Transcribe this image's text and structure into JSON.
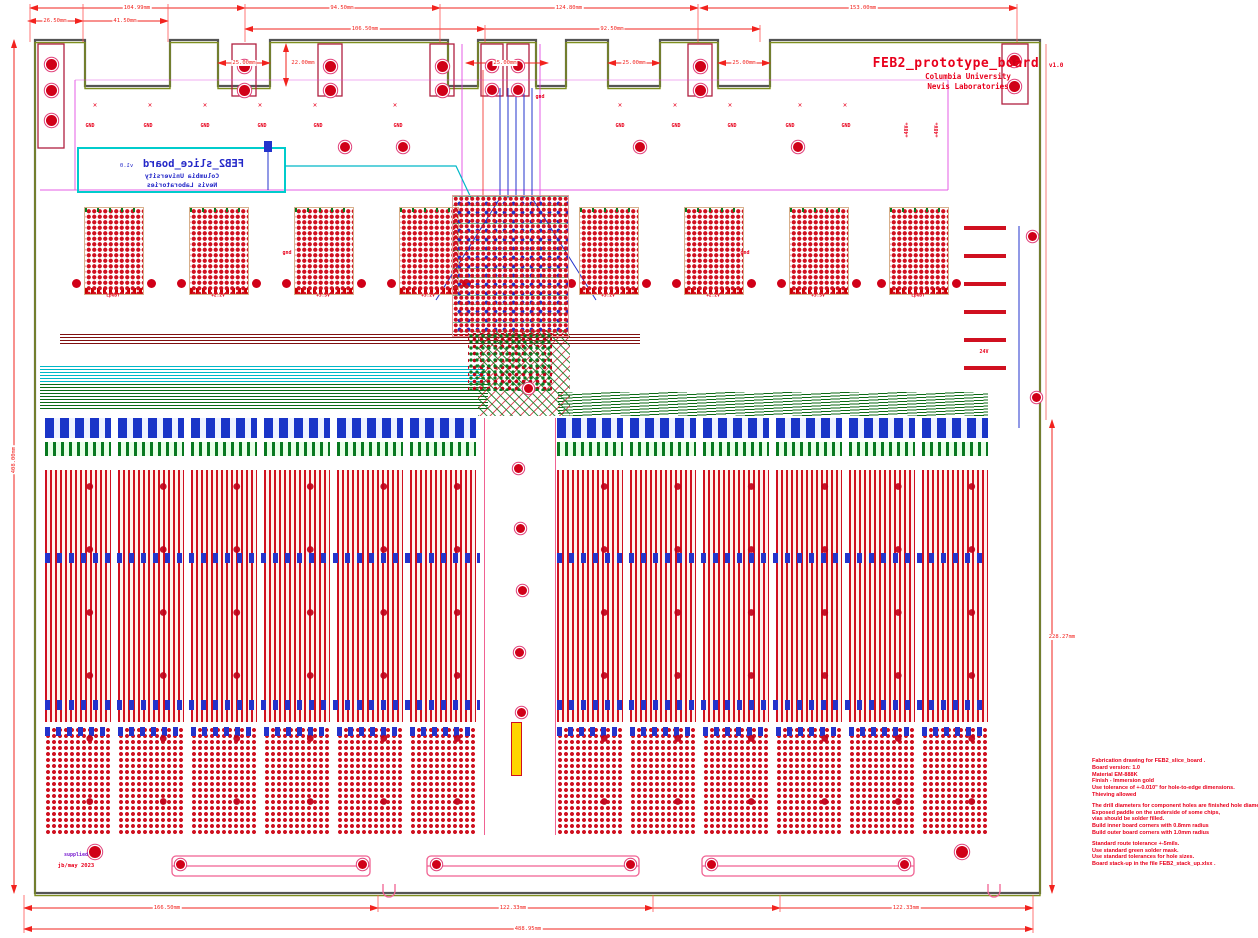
{
  "title_block": {
    "name": "FEB2_prototype_board",
    "version": "v1.0",
    "org": "Columbia University",
    "lab": "Nevis Laboratories"
  },
  "silkscreen": {
    "name": "FEB2_slice_board",
    "version": "v1.0",
    "org": "Columbia University",
    "lab": "Nevis Laboratories"
  },
  "net": {
    "gnd_row": [
      "GND",
      "GND",
      "GND",
      "GND",
      "GND",
      "GND",
      "GND",
      "GND",
      "GND",
      "GND",
      "GND"
    ],
    "p48_1": "+48V+",
    "p48_2": "+48V+",
    "v24": "24V",
    "gnd_1": "gnd",
    "gnd_2": "gnd",
    "gnd_3": "gnd"
  },
  "rails": [
    "LpGBT",
    "+2.2V",
    "+3.5V",
    "+3.2V",
    "+3.2V",
    "+2.2V",
    "+3.5V",
    "LpGBT"
  ],
  "dims": {
    "top_row1": [
      "104.99mm",
      "94.50mm",
      "124.80mm",
      "153.00mm"
    ],
    "top_row2": [
      "26.50mm",
      "41.50mm",
      "106.50mm",
      "92.50mm"
    ],
    "top_small": [
      "25.00mm",
      "22.00mm",
      "25.00mm",
      "25.00mm",
      "25.00mm"
    ],
    "bottom": [
      "166.50mm",
      "122.33mm",
      "122.33mm"
    ],
    "bottom_overall": "488.95mm",
    "left_overall": "408.00mm",
    "right_side": "228.27mm"
  },
  "notes": {
    "lines": [
      "Fabrication drawing for FEB2_slice_board .",
      "Board version: 1.0",
      "Material EM-888K",
      "Finish - Immersion gold",
      "Use tolerance of +-0.010\" for hole-to-edge dimensions.",
      "Thieving allowed",
      "",
      "The drill diameters for component holes are finished hole diameters",
      "Exposed paddle on the underside of some chips,",
      "vias should be solder filled.",
      "Build inner board corners with 0.8mm radius",
      "Build outer board corners with 1.0mm radius",
      "",
      "Standard route tolerance +-5mils.",
      "Use standard green solder mask.",
      "Use standard tolerances for hole sizes.",
      "Board stack-up in the file FEB2_stack_up.xlsx ."
    ]
  },
  "footer": {
    "note": "supplied",
    "date": "jb/may 2023"
  },
  "icons": {
    "x_mark": "✕"
  },
  "colors": {
    "dim_red": "#f2231e",
    "silk_red": "#e8001c",
    "silk_blue": "#2327c8",
    "copper_red": "#d01020",
    "ground_green": "#0b6b14",
    "teal": "#00cccc",
    "magenta": "#e040e0",
    "pink": "#f06292"
  },
  "drills": [
    [
      51,
      64,
      5.5
    ],
    [
      51,
      90,
      5.5
    ],
    [
      51,
      120,
      5.5
    ],
    [
      244,
      66,
      5.5
    ],
    [
      244,
      90,
      5.5
    ],
    [
      330,
      66,
      5.5
    ],
    [
      330,
      90,
      5.5
    ],
    [
      442,
      66,
      5.5
    ],
    [
      442,
      90,
      5.5
    ],
    [
      492,
      66,
      5
    ],
    [
      492,
      90,
      5
    ],
    [
      518,
      66,
      5
    ],
    [
      518,
      90,
      5
    ],
    [
      700,
      66,
      5.5
    ],
    [
      700,
      90,
      5.5
    ],
    [
      1014,
      60,
      5.5
    ],
    [
      1014,
      86,
      5.5
    ],
    [
      345,
      147,
      5
    ],
    [
      403,
      147,
      5
    ],
    [
      640,
      147,
      5
    ],
    [
      798,
      147,
      5
    ],
    [
      518,
      468,
      4.5
    ],
    [
      520,
      528,
      4.5
    ],
    [
      522,
      590,
      4.5
    ],
    [
      519,
      652,
      4.5
    ],
    [
      521,
      712,
      4.5
    ],
    [
      528,
      388,
      4.5
    ],
    [
      95,
      852,
      6
    ],
    [
      962,
      852,
      6
    ],
    [
      180,
      864,
      4.5
    ],
    [
      362,
      864,
      4.5
    ],
    [
      436,
      864,
      4.5
    ],
    [
      630,
      864,
      4.5
    ],
    [
      711,
      864,
      4.5
    ],
    [
      904,
      864,
      4.5
    ],
    [
      1032,
      236,
      4.5
    ],
    [
      1036,
      397,
      4.5
    ]
  ]
}
